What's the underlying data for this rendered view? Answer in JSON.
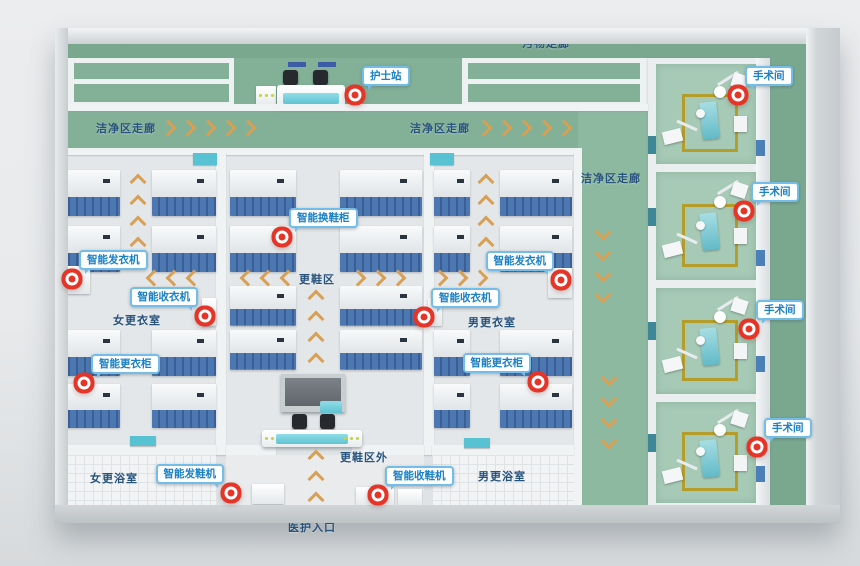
{
  "colors": {
    "corridor_green": "#83b197",
    "dirty_corridor_green": "#79a88f",
    "or_floor_green": "#a6cab6",
    "locker_blue": "#4d77b0",
    "arrow_tan": "#d7a055",
    "callout_text_blue": "#1b80c4",
    "callout_border_blue": "#74bde8",
    "marker_red": "#e53528",
    "area_label_navy": "#27527c",
    "door_teal": "#58c1d2"
  },
  "corridors": {
    "dirty_top": "污物走廊",
    "clean_left": "洁净区走廊",
    "clean_mid": "洁净区走廊",
    "clean_right": "洁净区走廊"
  },
  "areas": {
    "women_locker": "女更衣室",
    "men_locker": "男更衣室",
    "shoe_change": "更鞋区",
    "shoe_change_outside": "更鞋区外",
    "women_shower": "女更浴室",
    "men_shower": "男更浴室",
    "staff_entrance": "医护入口"
  },
  "callouts": [
    {
      "id": "nurse-station",
      "label": "护士站"
    },
    {
      "id": "operating-room-1",
      "label": "手术间"
    },
    {
      "id": "operating-room-2",
      "label": "手术间"
    },
    {
      "id": "operating-room-3",
      "label": "手术间"
    },
    {
      "id": "operating-room-4",
      "label": "手术间"
    },
    {
      "id": "smart-shoe-change-cabinet",
      "label": "智能换鞋柜"
    },
    {
      "id": "smart-clothes-dispenser-left",
      "label": "智能发衣机"
    },
    {
      "id": "smart-clothes-collector-left",
      "label": "智能收衣机"
    },
    {
      "id": "smart-clothes-dispenser-right",
      "label": "智能发衣机"
    },
    {
      "id": "smart-clothes-collector-right",
      "label": "智能收衣机"
    },
    {
      "id": "smart-changing-cabinet-left",
      "label": "智能更衣柜"
    },
    {
      "id": "smart-changing-cabinet-right",
      "label": "智能更衣柜"
    },
    {
      "id": "smart-shoe-dispenser",
      "label": "智能发鞋机"
    },
    {
      "id": "smart-shoe-collector",
      "label": "智能收鞋机"
    }
  ]
}
